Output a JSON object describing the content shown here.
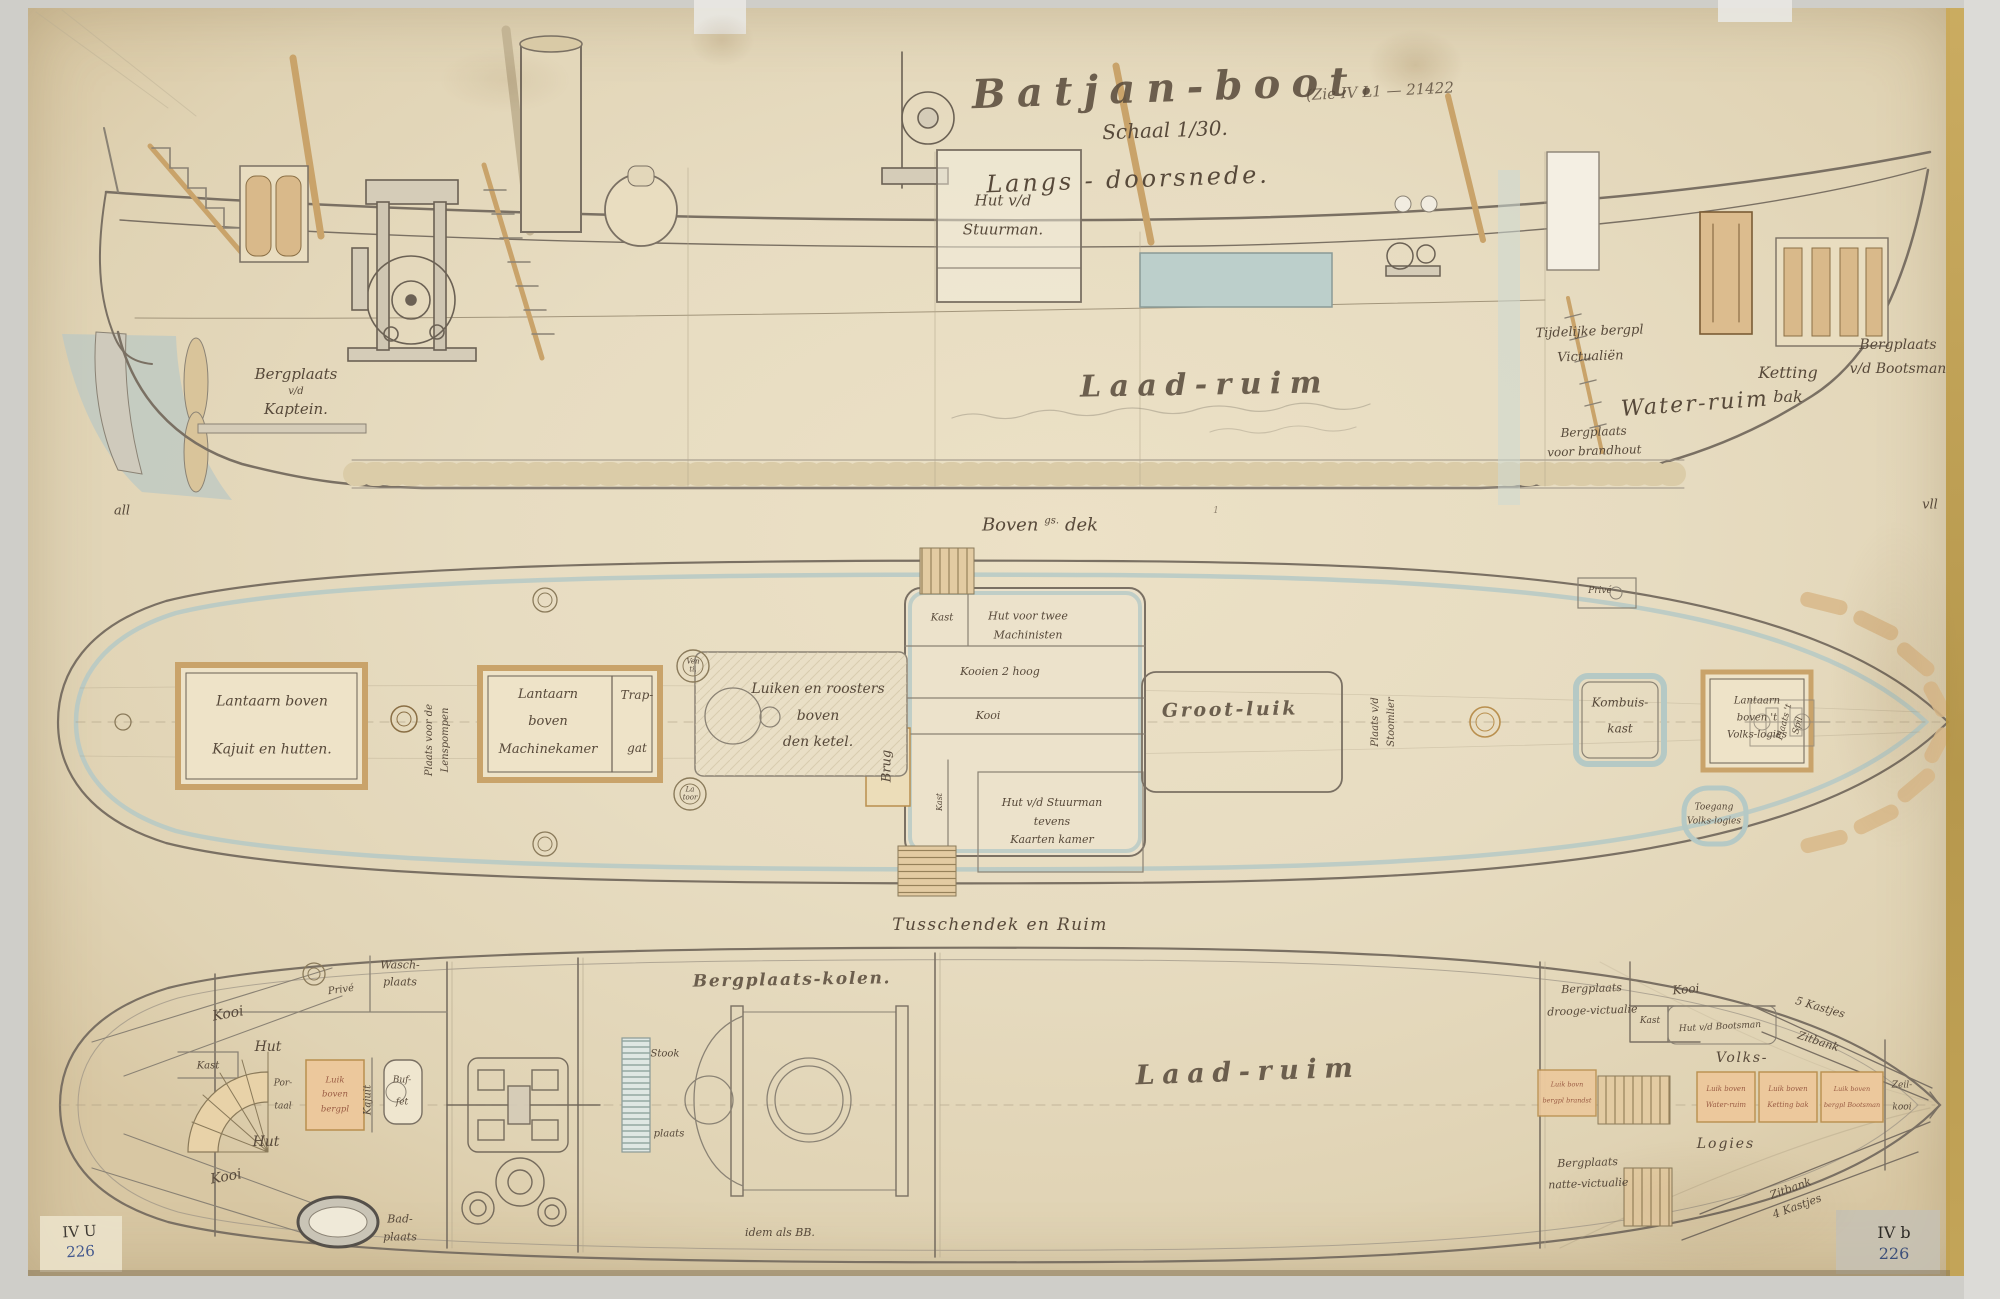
{
  "page": {
    "title": "Batjan-boot.",
    "title_ref": "(Zie IV L1 — 21422",
    "scale": "Schaal 1/30.",
    "subtitle": "Langs - doorsnede.",
    "cap_upper": [
      "Boven",
      "gs.",
      "dek"
    ],
    "cap_hold": "Tusschendek en Ruim",
    "mark_left": "all",
    "mark_right": "vll",
    "mark_station": "1"
  },
  "ls": {
    "hut_stuurman": [
      "Hut v/d",
      "Stuurman."
    ],
    "kaptein": [
      "Bergplaats",
      "v/d",
      "Kaptein."
    ],
    "laad_ruim": "Laad-ruim",
    "tijdelijke": [
      "Tijdelijke bergpl",
      "Victualiën"
    ],
    "water_ruim": "Water-ruim",
    "ketting": [
      "Ketting",
      "bak"
    ],
    "bootsman": [
      "Bergplaats",
      "v/d Bootsman"
    ],
    "brandhout": [
      "Bergplaats",
      "voor brandhout"
    ]
  },
  "dp": {
    "lantaarn_kajuit": [
      "Lantaarn boven",
      "Kajuit en hutten."
    ],
    "lenspompen": [
      "Plaats voor de",
      "Lenspompen"
    ],
    "lantaarn_machine": [
      "Lantaarn",
      "boven",
      "Machinekamer"
    ],
    "trapgat": [
      "Trap-",
      "gat"
    ],
    "vent": [
      "Ven",
      "ti."
    ],
    "lantoor": [
      "La",
      "toor"
    ],
    "luiken": [
      "Luiken en roosters",
      "boven",
      "den ketel."
    ],
    "kast": "Kast",
    "hut_machinisten": [
      "Hut voor twee",
      "Machinisten"
    ],
    "kooien": "Kooien 2 hoog",
    "kooi": "Kooi",
    "brug": "Brug",
    "kast_v": "Kast",
    "hut_kaarten": [
      "Hut v/d Stuurman",
      "tevens",
      "Kaarten kamer"
    ],
    "groot_luik": "Groot-luik",
    "stoomlier": [
      "Plaats v/d",
      "Stoomlier"
    ],
    "kombuis": [
      "Kombuis-",
      "kast"
    ],
    "toegang": [
      "Toegang",
      "Volks-logies"
    ],
    "lantaarn_volks": [
      "Lantaarn",
      "boven 't",
      "Volks-logies"
    ],
    "spil": [
      "Plaats 't",
      "Spil"
    ],
    "prive": "Privé"
  },
  "hp": {
    "wasch": [
      "Wasch-",
      "plaats"
    ],
    "prive": "Privé",
    "kooi_top": "Kooi",
    "hut_top": "Hut",
    "kast": "Kast",
    "portaal": [
      "Por-",
      "taal"
    ],
    "luik_bergpl": [
      "Luik",
      "boven",
      "bergpl"
    ],
    "kajuit": "Kajuit",
    "buffet": [
      "Buf-",
      "fet"
    ],
    "hut_bottom": "Hut",
    "kooi_bottom": "Kooi",
    "bad": [
      "Bad-",
      "plaats"
    ],
    "kolen": "Bergplaats-kolen.",
    "stook": "Stook",
    "stook_plaats": "plaats",
    "idem": "idem als BB.",
    "laad_ruim": "Laad-ruim",
    "droge": [
      "Bergplaats",
      "drooge-victualie"
    ],
    "kooi_right": "Kooi",
    "kast_right": "Kast",
    "hut_bootsman": "Hut v/d Bootsman",
    "kastjes": "5 Kastjes",
    "zitbank": "Zitbank",
    "volks": "Volks-",
    "logies": "Logies",
    "luik_water": [
      "Luik boven",
      "Water-ruim"
    ],
    "luik_ketting": [
      "Luik boven",
      "Ketting bak"
    ],
    "luik_bootsman": [
      "Luik boven",
      "bergpl Bootsman"
    ],
    "luik_brandstof": [
      "Luik bovn",
      "bergpl brandst"
    ],
    "zeil_kooi": [
      "Zeil-",
      "kooi"
    ],
    "natte": [
      "Bergplaats",
      "natte-victualie"
    ],
    "zitbank4": [
      "Zitbank",
      "4 Kastjes"
    ]
  },
  "stamps": {
    "left": [
      "IV U",
      "226"
    ],
    "right": [
      "IV b",
      "226"
    ]
  },
  "colors": {
    "paper": "#e7dcc1",
    "paper-dark": "#d8c7a3",
    "ink": "#57493a",
    "line": "#7a7063",
    "tan": "#c9a36a",
    "wood": "#d9b98a",
    "blue": "#b5c9c5",
    "blue-deep": "#9fb6b1",
    "orange": "#ecc89c",
    "rust": "#9a5c44",
    "stamp-blue": "#44598e"
  }
}
